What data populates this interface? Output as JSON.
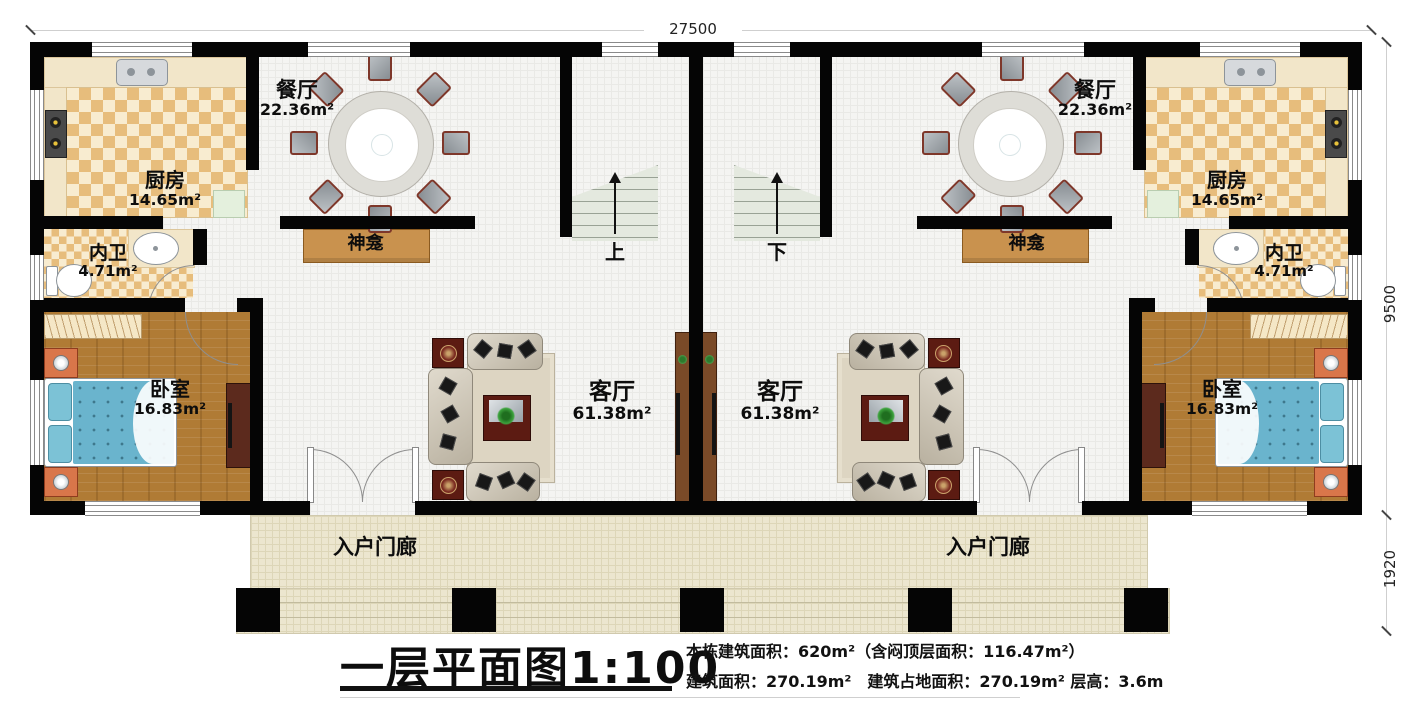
{
  "dimensions": {
    "top_width": "27500",
    "side_main": "9500",
    "side_porch": "1920"
  },
  "rooms": {
    "dining": {
      "name": "餐厅",
      "area": "22.36m²"
    },
    "kitchen": {
      "name": "厨房",
      "area": "14.65m²"
    },
    "bathroom": {
      "name": "内卫",
      "area": "4.71m²"
    },
    "bedroom": {
      "name": "卧室",
      "area": "16.83m²"
    },
    "living": {
      "name": "客厅",
      "area": "61.38m²"
    },
    "shrine": {
      "name": "神龛"
    },
    "porch": {
      "name": "入户门廊"
    }
  },
  "stairs": {
    "left_label": "上",
    "right_label": "下"
  },
  "title_block": {
    "title": "一层平面图1:100",
    "info_line1": "本栋建筑面积：620m²（含闷顶层面积：116.47m²）",
    "info_line2": "建筑面积：270.19m²　建筑占地面积：270.19m² 层高：3.6m"
  },
  "colors": {
    "wall": "#050505",
    "checker": "#e7bd7c",
    "wood": "#b07b35",
    "porch": "#ece6cf",
    "shrine": "#c9924e",
    "bed": "#6ab4cd"
  }
}
